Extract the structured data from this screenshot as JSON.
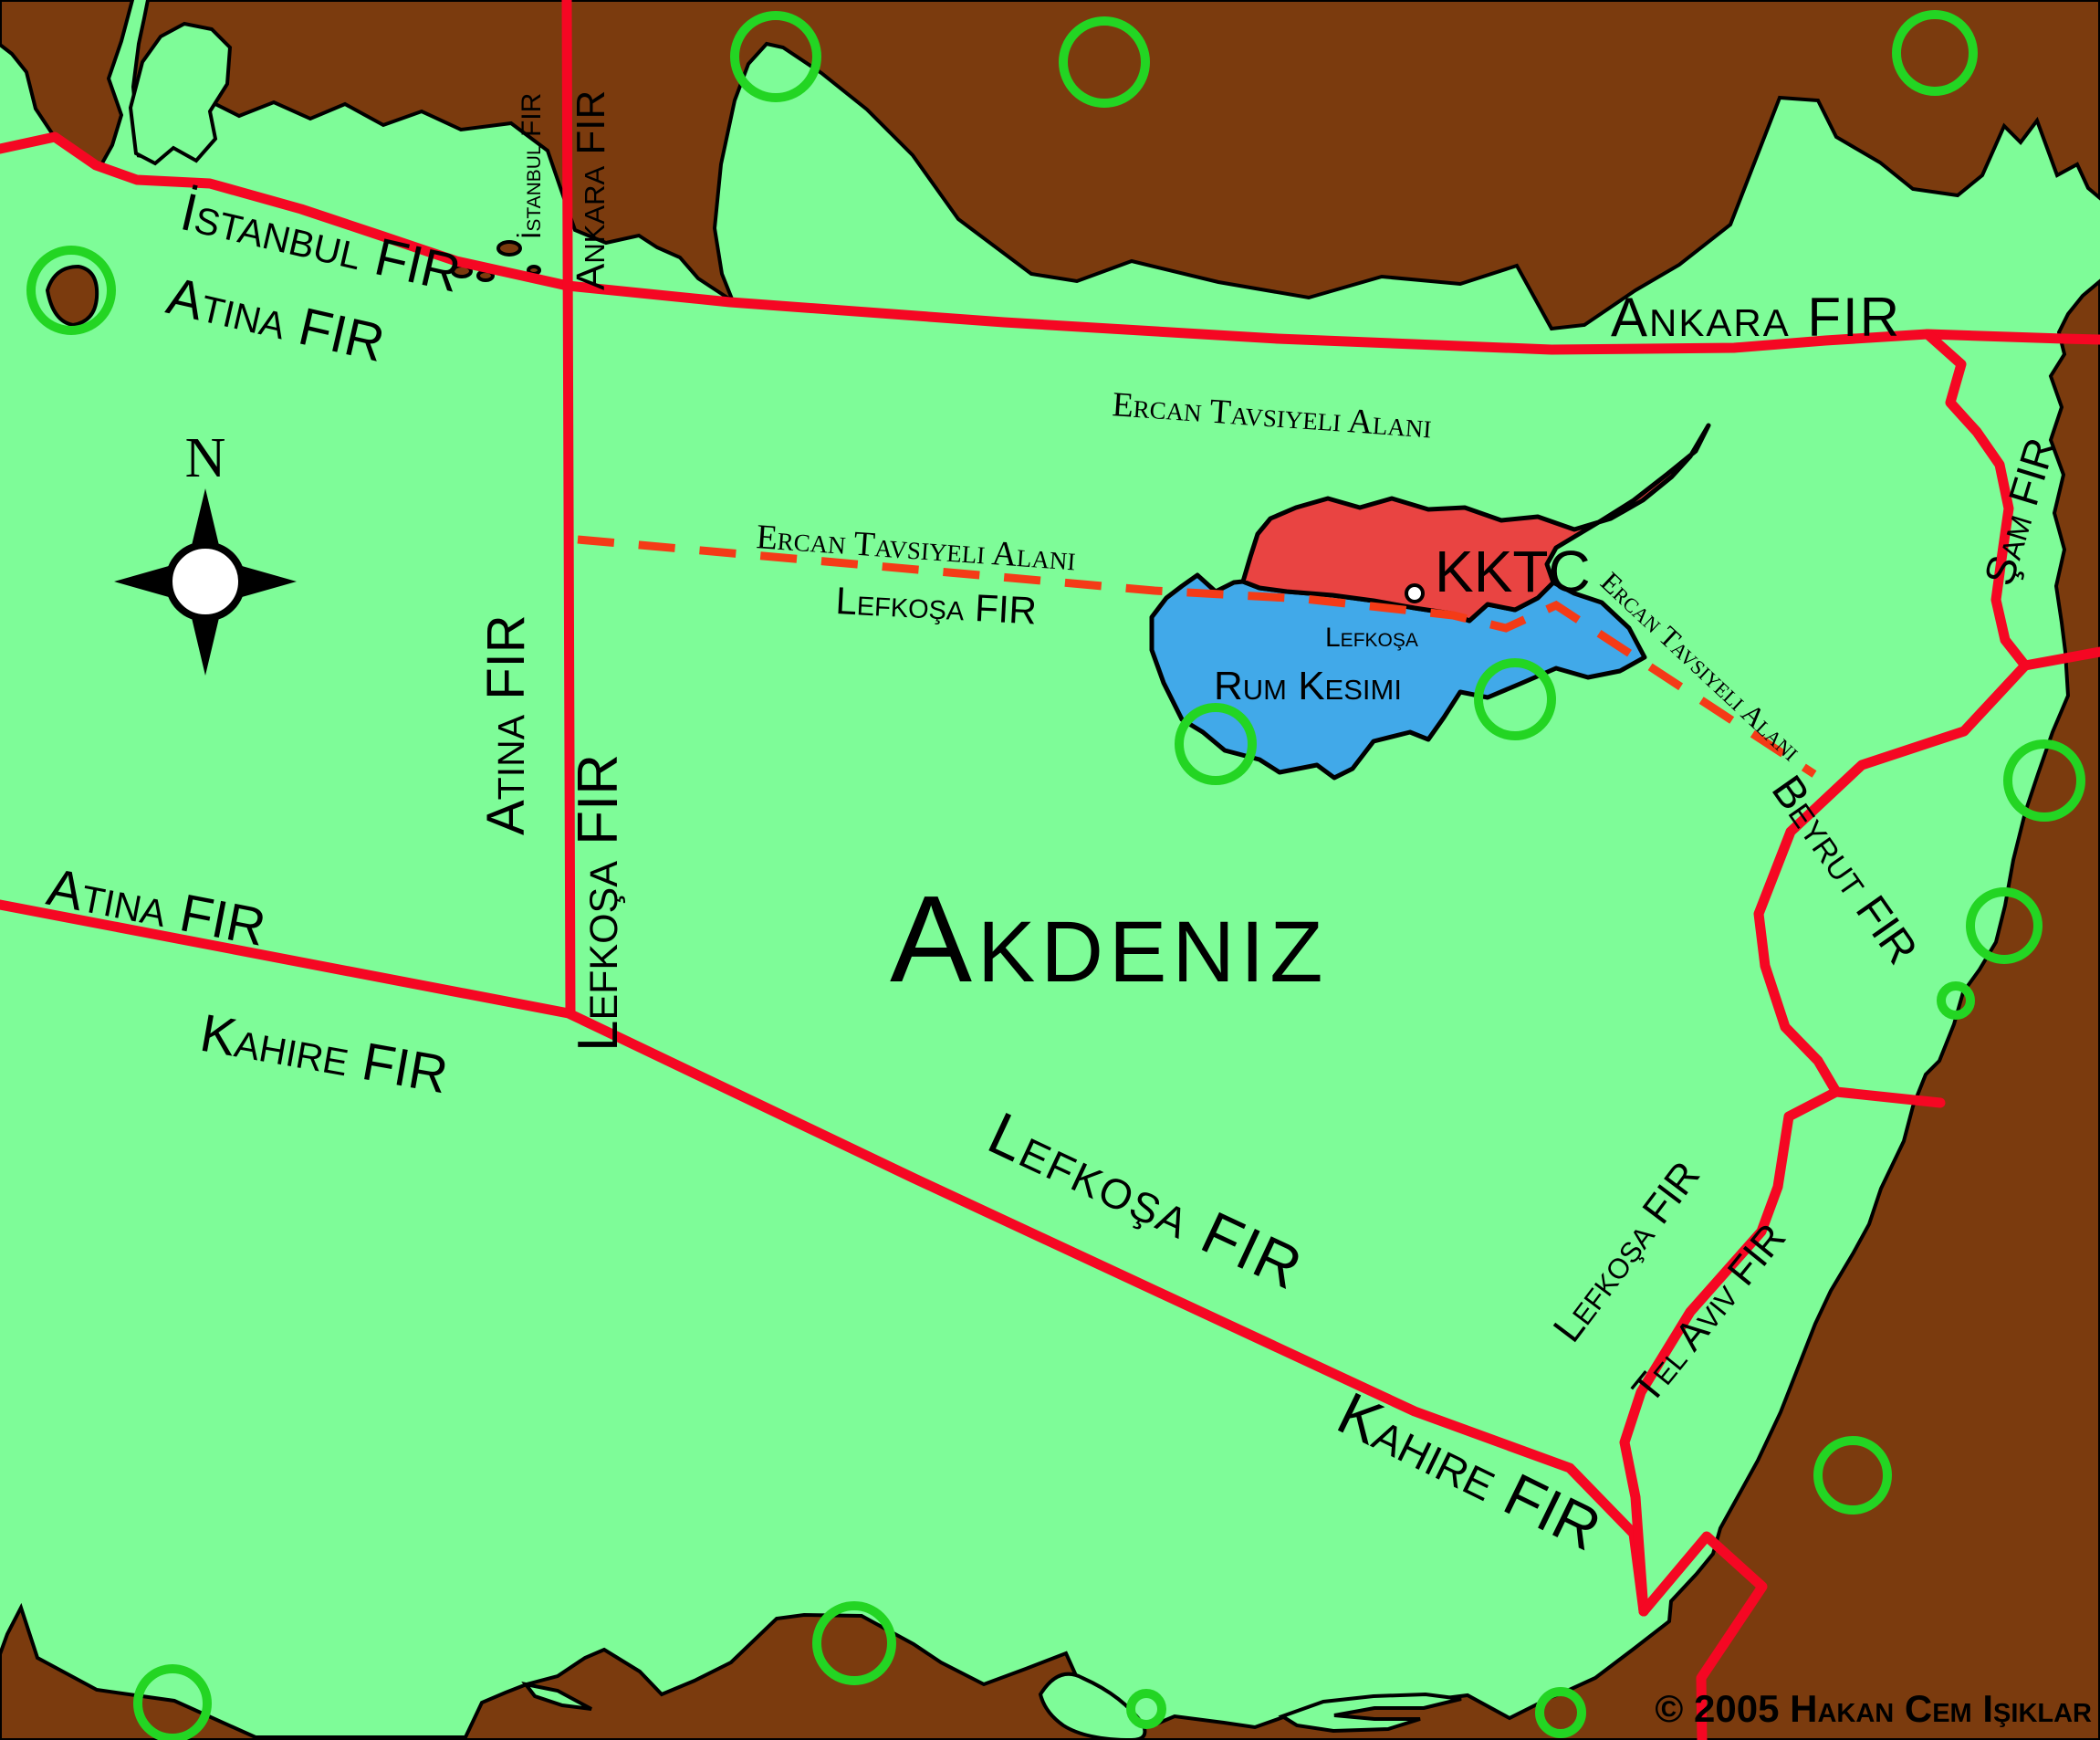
{
  "compass": {
    "north": "N"
  },
  "firs": {
    "istanbul": "İstanbul FIR",
    "ankara": "Ankara FIR",
    "atina": "Atina FIR",
    "lefkosa": "Lefkoşa FIR",
    "kahire": "Kahire FIR",
    "sam": "Şam FIR",
    "beyrut": "Beyrut FIR",
    "telaviv": "Tel Aviv FIR"
  },
  "advisory_area": "Ercan Tavsiyeli Alanı",
  "sea_label": "Akdeniz",
  "island": {
    "north_region": "KKTC",
    "south_region": "Rum Kesimi",
    "capital": "Lefkoşa"
  },
  "copyright": "© 2005 Hakan Cem Işıklar",
  "colors": {
    "sea": "#7EFC98",
    "land": "#7B3B0E",
    "fir_line_red": "#F50723",
    "advisory_dash_red": "#F43B17",
    "kktc_fill": "#E94442",
    "rum_fill": "#41A9E9",
    "waypoint_circle_green": "#23D523",
    "sea_label_gray": "#6F8077"
  }
}
